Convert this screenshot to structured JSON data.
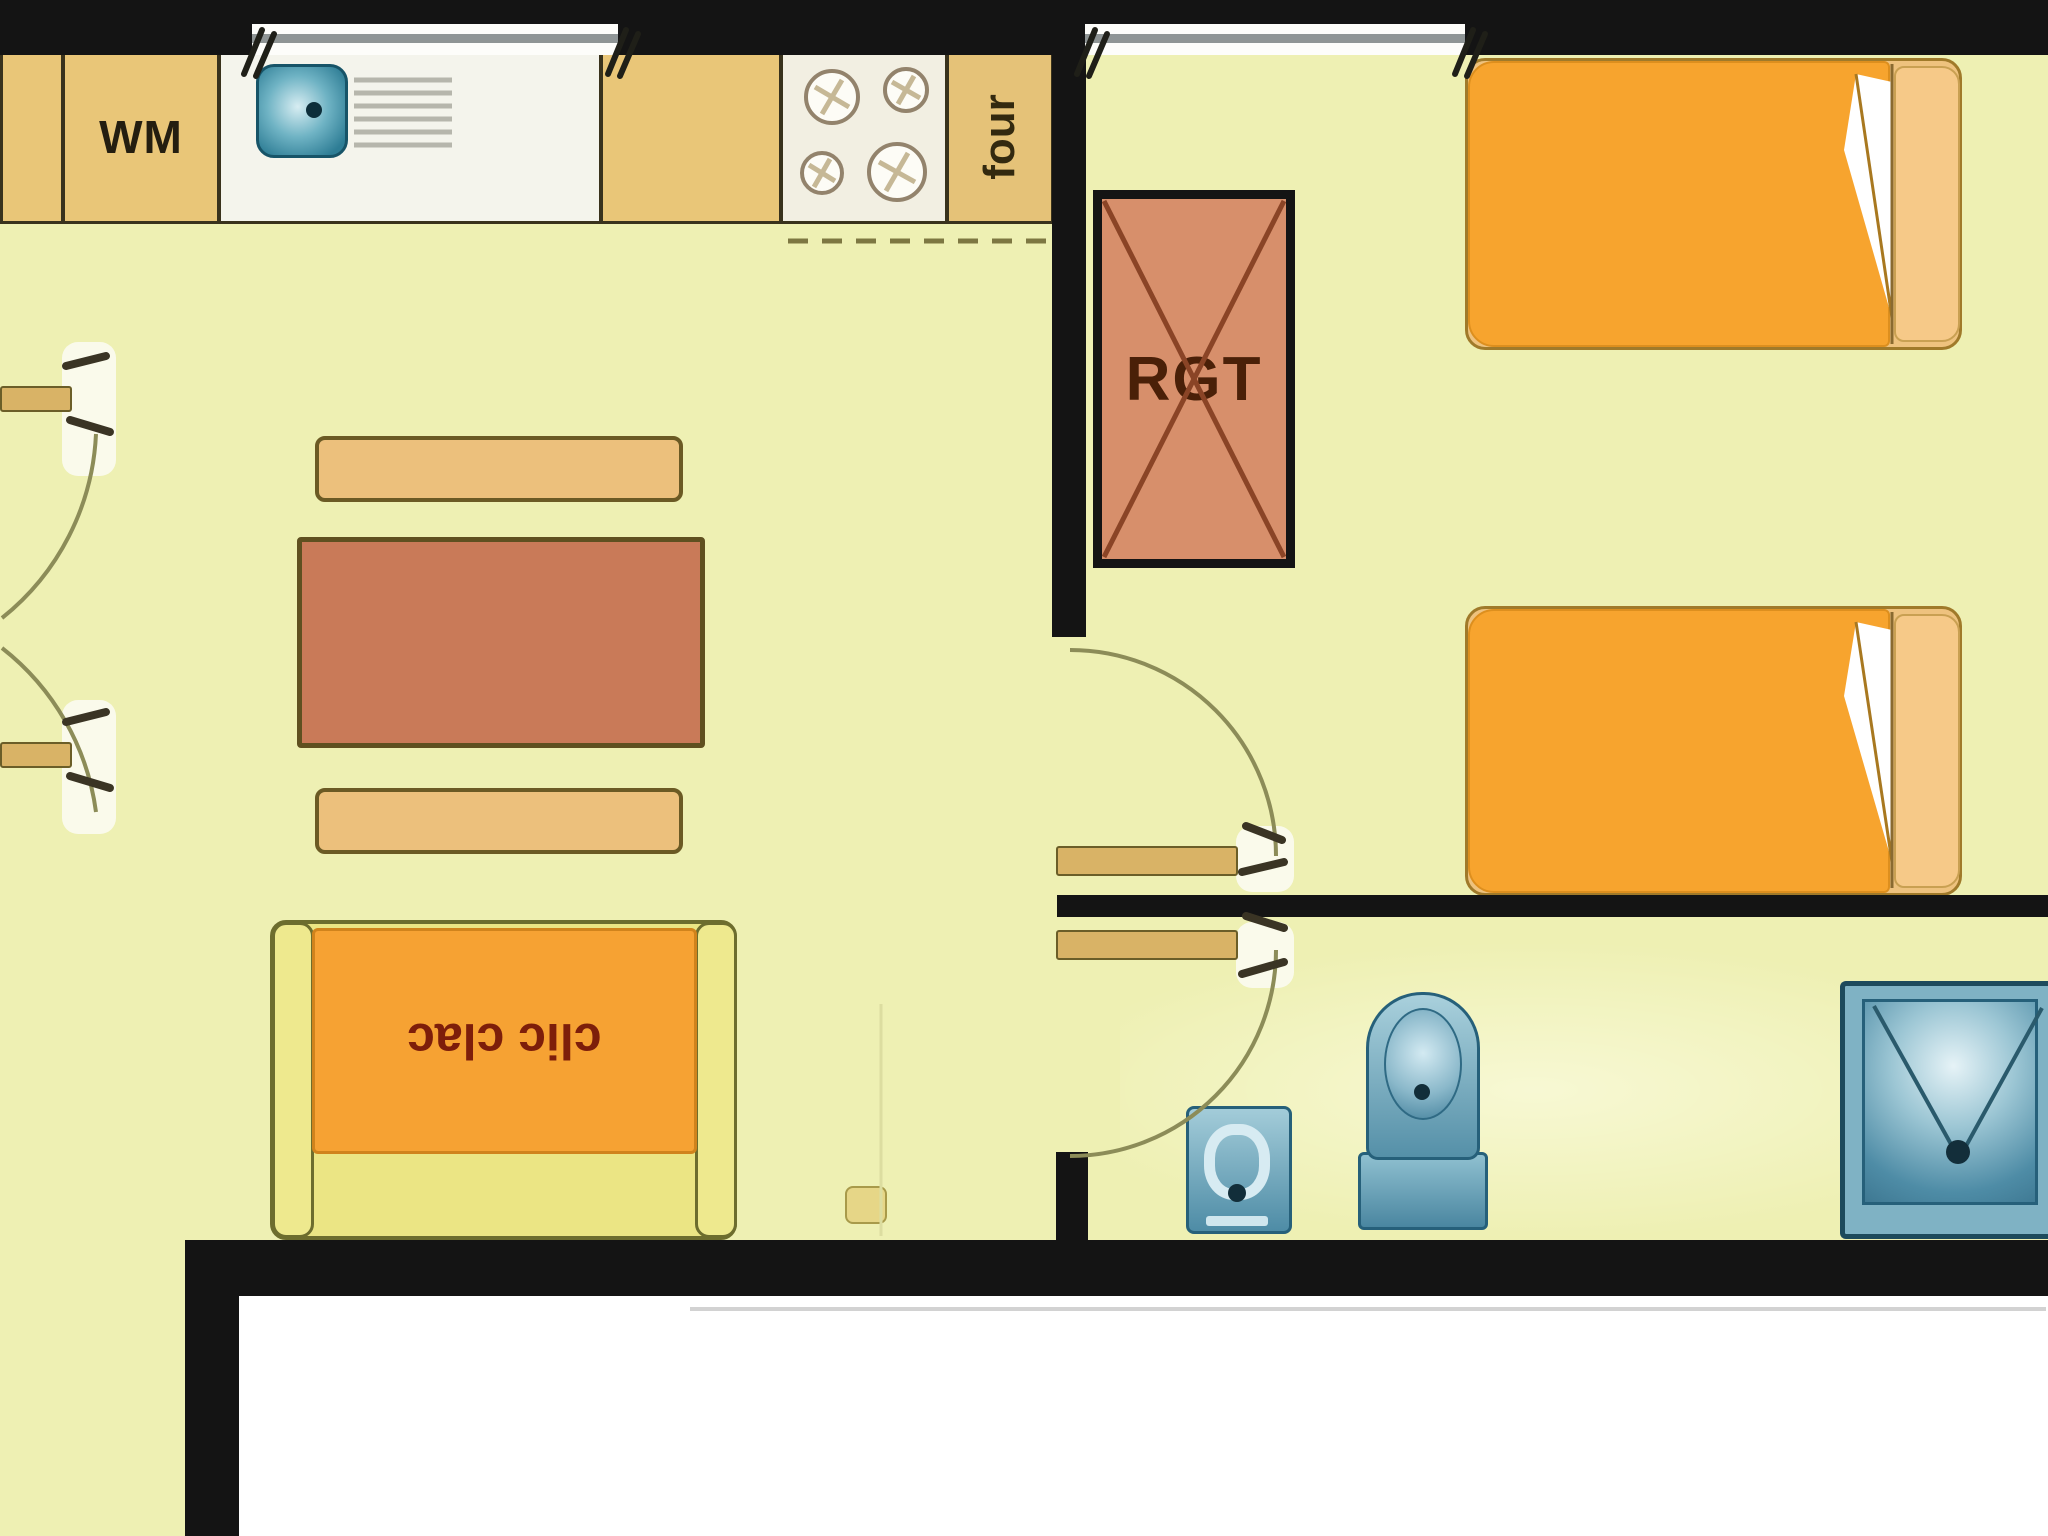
{
  "plan_title": "studio apartment floor plan",
  "labels": {
    "washing_machine": "WM",
    "oven": "four",
    "storage_closet": "RGT",
    "sofa_bed": "clic clac"
  },
  "colors": {
    "floor": "#eef0b3",
    "wall": "#141414",
    "outside": "#ffffff",
    "counter_tan": "#e9c678",
    "sink_unit_white": "#f4f4ec",
    "stove_unit_white": "#f2efe2",
    "appliance_teal": "#2e7d95",
    "fixture_blue": "#5590a8",
    "fixture_blue_light": "#d7ebf2",
    "fixture_border": "#26607a",
    "closet_fill": "#d78f6b",
    "closet_cross": "#8a4426",
    "bed_blanket_orange": "#f7a42e",
    "bed_pillow": "#f6c988",
    "bed_frame": "#eec27e",
    "table_terracotta": "#c97a58",
    "bench_tan": "#ecc07c",
    "sofa_frame_yellow": "#ebe584",
    "sofa_seat_orange": "#f6a233",
    "door_leaf": "#d9b366",
    "swing_arc": "#8c8c58",
    "window_glass": "#8f9595",
    "label_dark": "#241e10",
    "label_storage": "#4a2008",
    "label_sofa_red": "#7d1e0a"
  },
  "fixtures": [
    "washing-machine",
    "kitchen-sink",
    "drainboard",
    "stove-burners",
    "oven",
    "storage-closet",
    "single-bed-1",
    "single-bed-2",
    "dining-table",
    "bench-top",
    "bench-bottom",
    "sofa-bed",
    "toilet",
    "pedestal-basin",
    "shower",
    "french-door-left-top",
    "french-door-left-bottom",
    "bedroom-door",
    "bathroom-door",
    "window-kitchen",
    "window-bedroom"
  ]
}
